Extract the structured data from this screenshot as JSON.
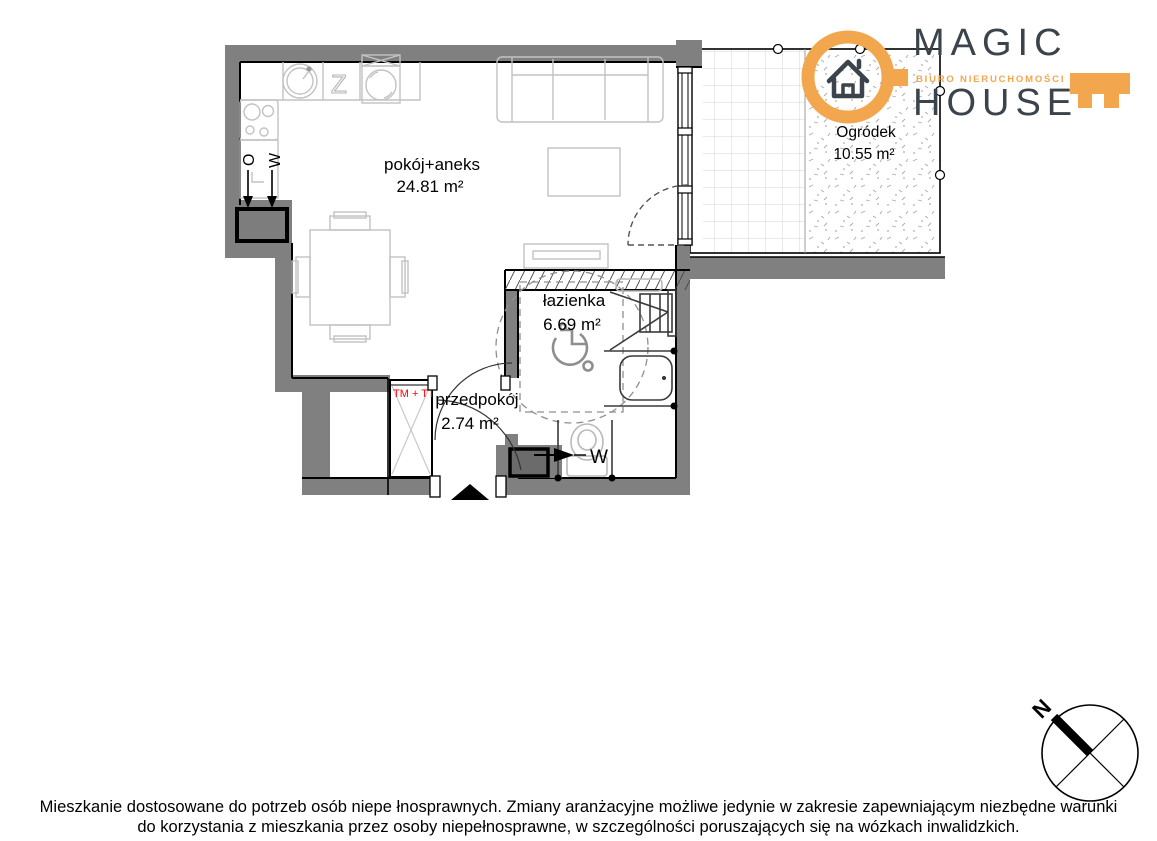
{
  "plan": {
    "rooms": [
      {
        "id": "living",
        "name": "pokój+aneks",
        "area": "24.81 m²"
      },
      {
        "id": "bathroom",
        "name": "łazienka",
        "area": "6.69 m²"
      },
      {
        "id": "hallway",
        "name": "przedpokój",
        "area": "2.74 m²"
      },
      {
        "id": "garden",
        "name": "Ogródek",
        "area": "10.55 m²"
      }
    ],
    "markers": {
      "kitchen_zone": "Z",
      "vent_o": "O",
      "vent_w_kitchen": "W",
      "vent_w_bathroom": "W",
      "tech_cabinet": "TM + TT"
    },
    "compass_north": "N"
  },
  "logo": {
    "word1": "MAGIC",
    "word2": "HOUSE",
    "tagline": "BIURO NIERUCHOMOŚCI",
    "accent_color": "#f2a74e",
    "text_color": "#3b434c"
  },
  "footer": {
    "line1": "Mieszkanie dostosowane do potrzeb osób niepe łnosprawnych. Zmiany aranżacyjne możliwe jedynie w zakresie zapewniającym niezbędne warunki",
    "line2": "do korzystania z mieszkania przez osoby niepełnosprawne, w szczególności poruszających się na wózkach inwalidzkich."
  },
  "colors": {
    "wall": "#808080",
    "furniture_outline": "#c2c2c2",
    "cabinet_label": "#ff0000"
  }
}
